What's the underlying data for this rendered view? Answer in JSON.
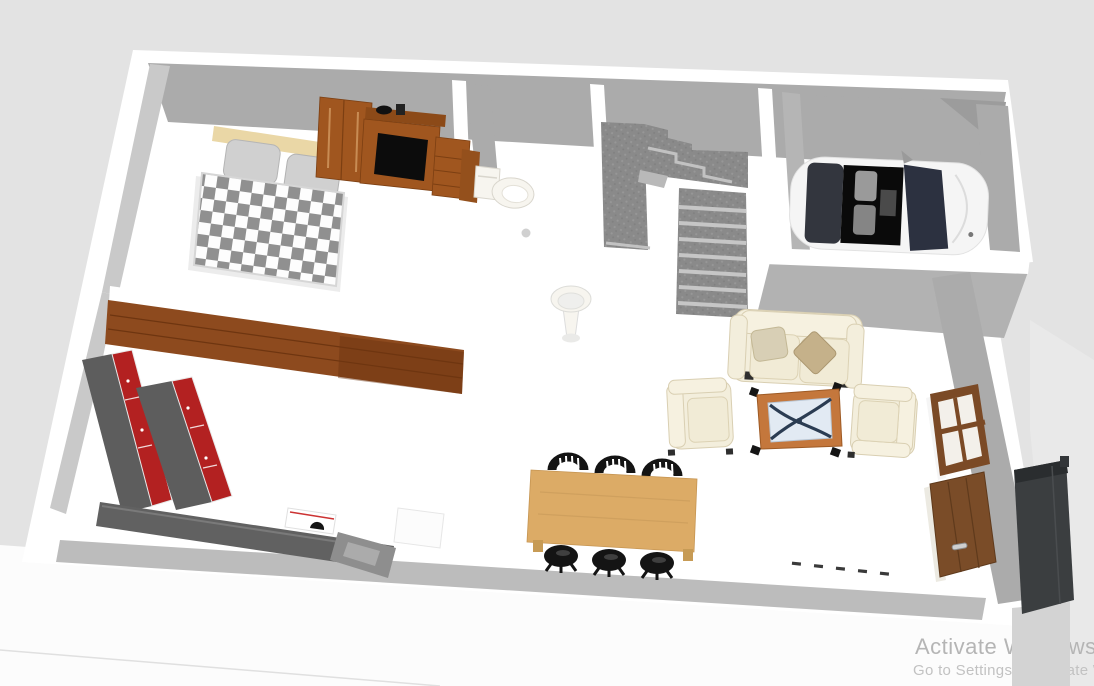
{
  "watermark": {
    "line1": "Activate Windows",
    "line2": "Go to Settings to activate W"
  },
  "colors": {
    "bg": "#e3e3e3",
    "ground": "#fcfcfc",
    "ground_right": "#e9e9e9",
    "ground_strip": "#d3d3d3",
    "wall_top": "#ffffff",
    "wall_face": "#ababab",
    "wall_face_light": "#c9c9c9",
    "wall_shadow": "#bcbcbc",
    "stair_carpet": "#8a8a8a",
    "stair_tread": "#c6c6c6",
    "wood_floor": "#8d4a1e",
    "wood_floor_dark": "#6b3410",
    "checker_gray": "#909090",
    "checker_white": "#fdfdfd",
    "bed_underlay": "#ececec",
    "headboard": "#ead7a6",
    "pillow_gray": "#d0d0d0",
    "wardrobe_wood": "#a0561f",
    "wardrobe_wood_dark": "#8c4a18",
    "tv_screen": "#0c0c0c",
    "porcelain": "#f7f5ef",
    "car_body": "#f5f5f5",
    "car_rear": "#33363e",
    "car_cabin": "#0a0a0a",
    "car_seat": "#9a9a9a",
    "car_windshield": "#2c3140",
    "sofa_cream": "#f3eedc",
    "pillow_tan": "#d8cfb5",
    "pillow_tan_dark": "#c5b18a",
    "table_frame": "#c4773c",
    "table_glass": "#e2eaf3",
    "table_leg": "#2b3c52",
    "dining_wood": "#dcab66",
    "chair_black": "#141414",
    "cab_gray": "#5d5d5d",
    "cab_red": "#b32121",
    "counter": "#616161",
    "counter_light": "#8e8e8e",
    "cooktop": "#ffffff",
    "appliance": "#fcfcfc",
    "window_frame": "#7b4a26",
    "window_pane": "#f3f0ea",
    "door_wood": "#7a4c28",
    "door_jamb": "#eceae2",
    "door_handle": "#cfcfcf",
    "dark_unit": "#3b3e40",
    "dark_unit_top": "#2a2d2f",
    "dash": "#3a3a3a",
    "watermark_primary": "#b5b5b5",
    "watermark_secondary": "#c2c2c2"
  }
}
